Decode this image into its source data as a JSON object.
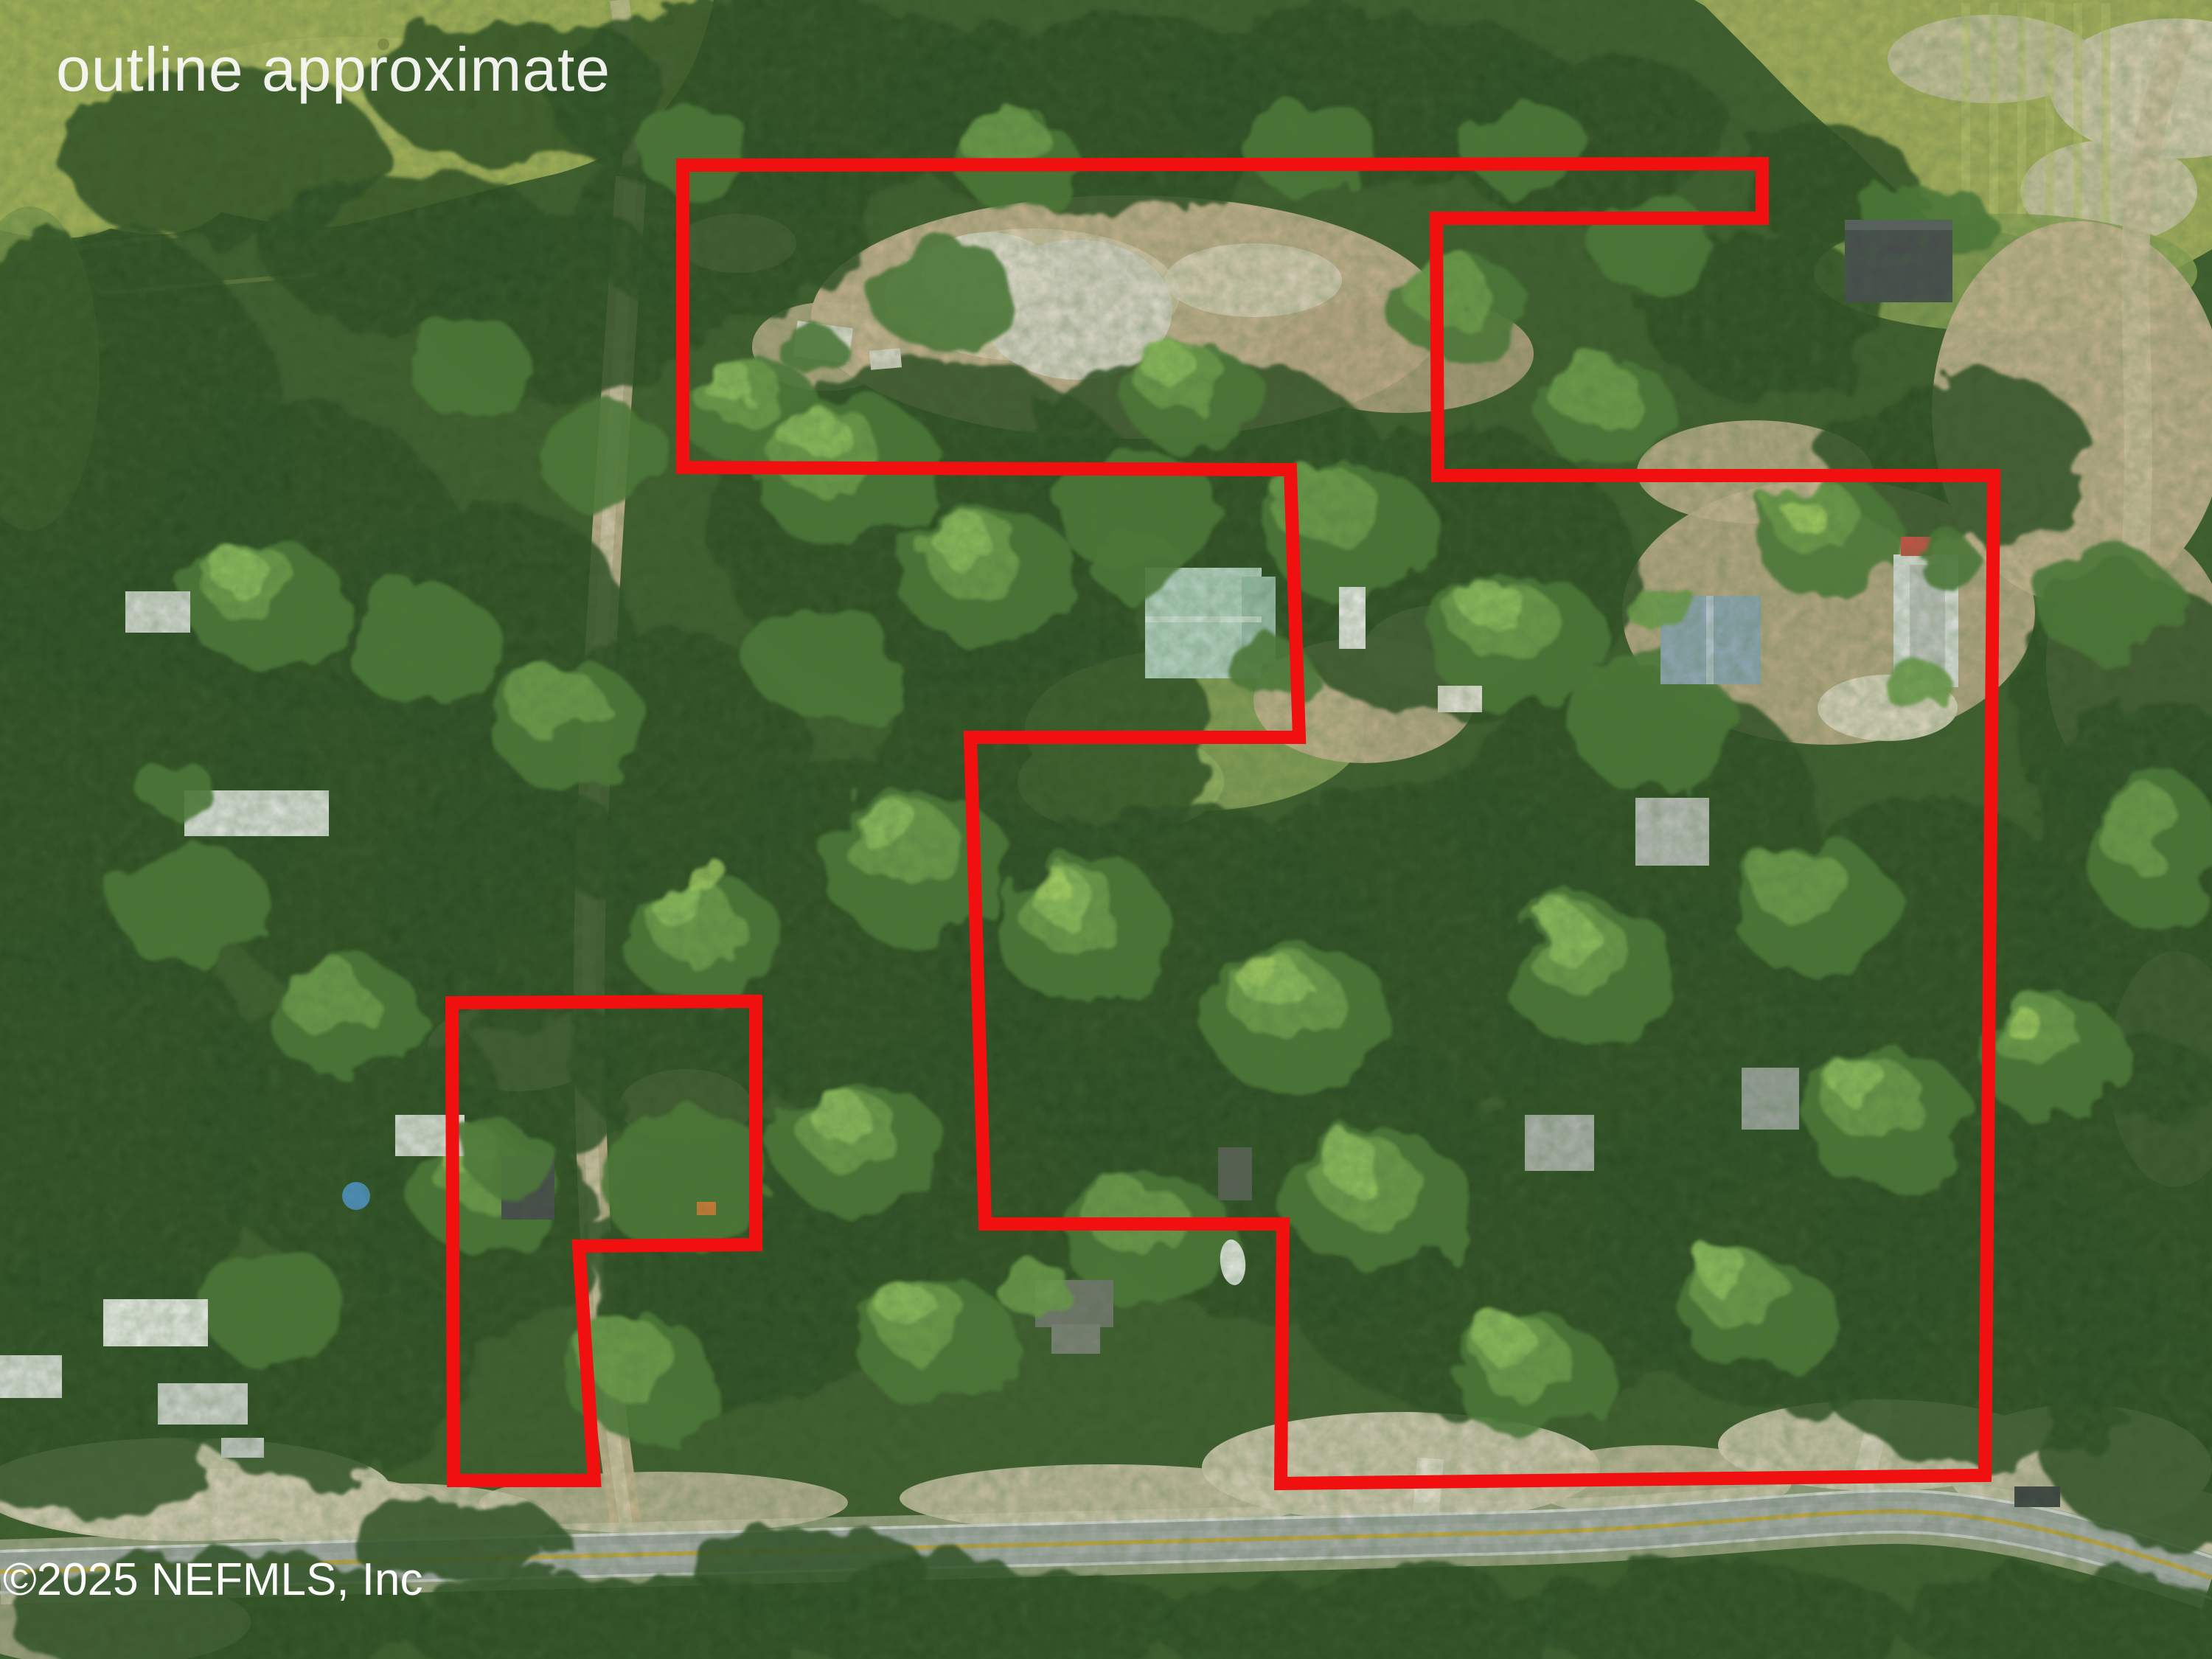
{
  "watermark": {
    "text": "outline approximate",
    "color": "#f7f7f4"
  },
  "copyright": {
    "text": "©2025 NEFMLS, Inc",
    "color": "#ffffff"
  },
  "outline": {
    "color": "#f01010",
    "stroke_width": 18,
    "main_parcel_points": "926,224 2390,222 2390,296 1948,296 1950,645 2704,645 2692,2001 1737,2012 1740,1660 1336,1660 1316,1000 1762,1000 1750,637 926,634",
    "small_parcel_points": "613,1360 1025,1358 1025,1688 785,1690 806,2008 615,2008"
  },
  "palette": {
    "canopy_base": "#3c5a2b",
    "canopy_dark": "#2c4a22",
    "canopy_mid": "#4e7938",
    "canopy_light": "#6f9e4b",
    "canopy_highlight": "#92c25f",
    "field_grass": "#a5b259",
    "sand": "#c6b190",
    "white_sand": "#ded9cc",
    "dirt_road": "#c9b695",
    "asphalt": "#a4a8a6",
    "road_center_line": "#c9a83e",
    "teal_roof": "#b5d4c5",
    "pool_blue": "#4c90c8"
  }
}
